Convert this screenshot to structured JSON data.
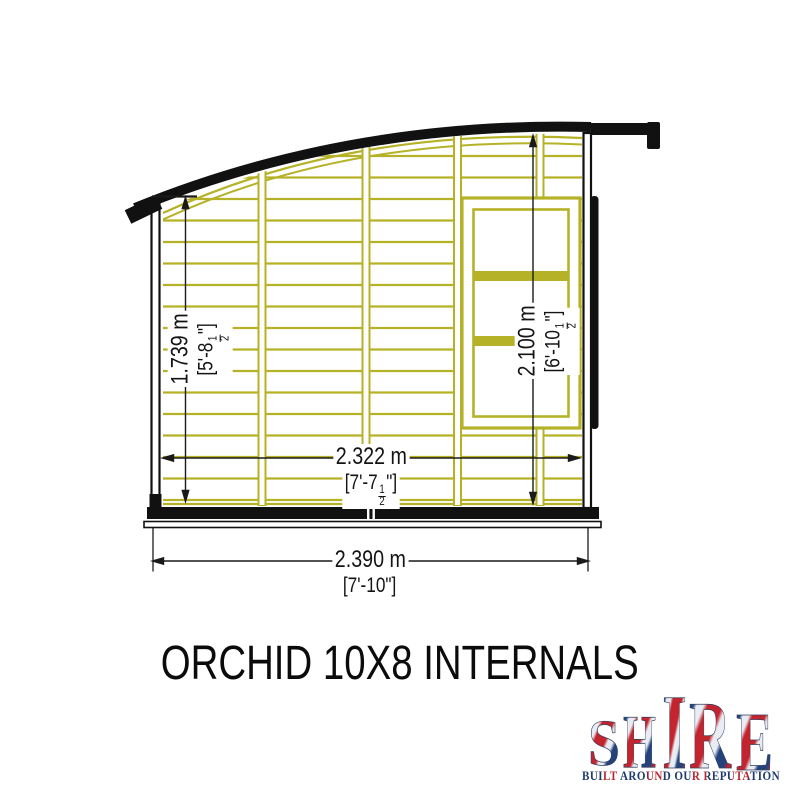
{
  "title": "ORCHID 10X8 INTERNALS",
  "diagram": {
    "dims": {
      "height_left": {
        "metric": "1.739 m",
        "imp_main": "[5'-8",
        "frac_num": "1",
        "frac_den": "2",
        "imp_suffix": "\"]"
      },
      "height_right": {
        "metric": "2.100 m",
        "imp_main": "[6'-10",
        "frac_num": "1",
        "frac_den": "2",
        "imp_suffix": "\"]"
      },
      "width_internal": {
        "metric": "2.322 m",
        "imp_main": "[7'-7",
        "frac_num": "1",
        "frac_den": "2",
        "imp_suffix": "\"]"
      },
      "width_overall": {
        "metric": "2.390 m",
        "imperial": "[7'-10\"]"
      }
    },
    "colors": {
      "framing": "#b6b228",
      "outline": "#111111"
    }
  },
  "logo": {
    "letters": [
      "S",
      "H",
      "I",
      "R",
      "E"
    ],
    "tagline": "BUILT AROUND OUR REPUTATION",
    "navy": "#1e3a6d",
    "red": "#bb2731"
  }
}
